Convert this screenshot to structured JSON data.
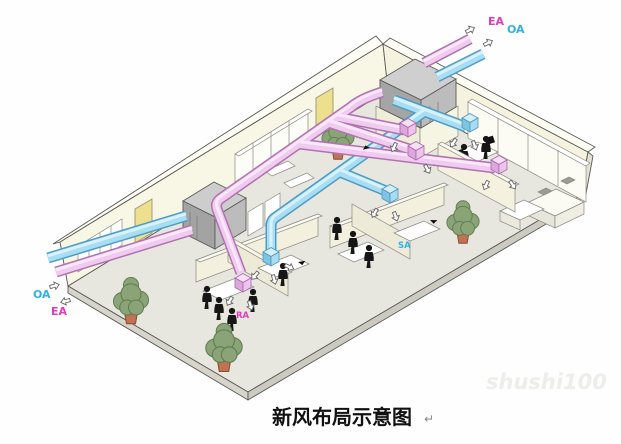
{
  "page": {
    "caption": "新风布局示意图",
    "paragraph_mark": "↵",
    "watermark": "shushi100"
  },
  "labels": {
    "outlet_ea": "EA",
    "outlet_oa": "OA",
    "inlet_oa": "OA",
    "inlet_ea": "EA",
    "supply_air": "SA",
    "return_air": "RA"
  },
  "colors": {
    "exhaust_duct": "#f0cbf0",
    "exhaust_outline": "#b172b0",
    "fresh_duct": "#a8def4",
    "fresh_outline": "#4d9cc4",
    "ea_label": "#e03db8",
    "oa_label": "#2fb3e6",
    "wall_cream": "#f8f6e4",
    "floor_gray": "#e7e6df",
    "ahu_gray": "#bcbcbc",
    "door_yellow": "#ecdf8e",
    "plant_green": "#8aa477"
  }
}
